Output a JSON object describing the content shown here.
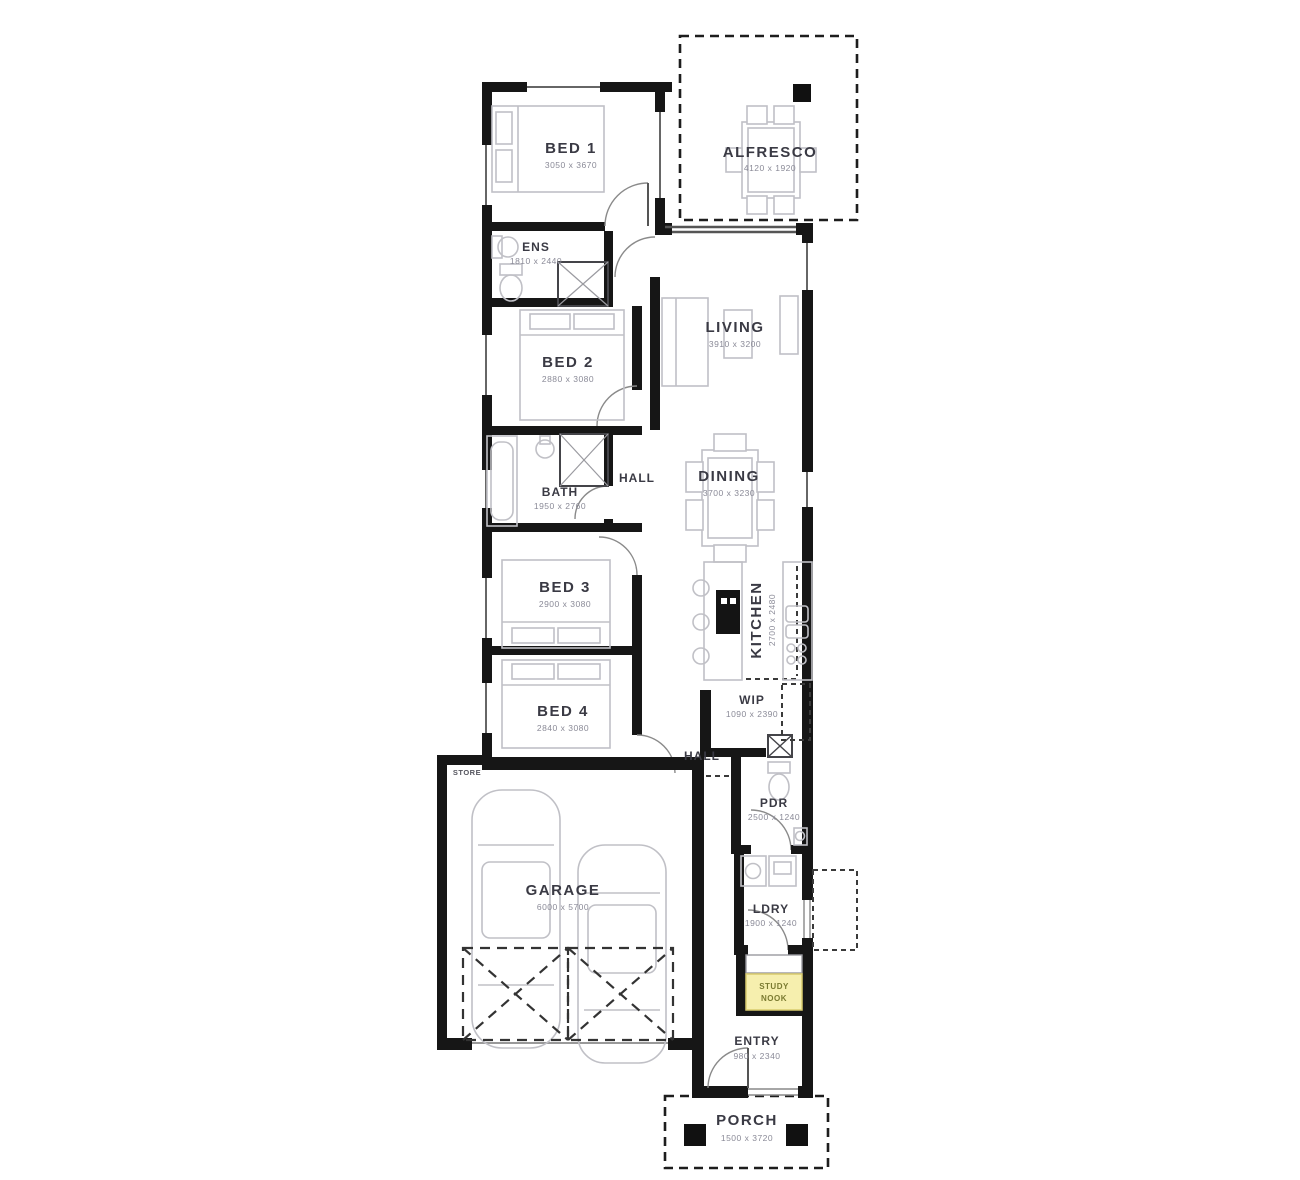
{
  "plan_title": "single storey house floor plan",
  "colors": {
    "wall": "#161616",
    "furniture": "#c0c0c6",
    "label": "#3a3a44",
    "dims": "#8a8a97",
    "nook_fill": "#f6efae",
    "nook_border": "#d9cc6e",
    "background": "#ffffff"
  },
  "rooms": {
    "bed1": {
      "label": "BED 1",
      "dims": "3050 x 3670"
    },
    "alfresco": {
      "label": "ALFRESCO",
      "dims": "4120 x 1920"
    },
    "ens": {
      "label": "ENS",
      "dims": "1810 x 2440"
    },
    "living": {
      "label": "LIVING",
      "dims": "3910 x 3200"
    },
    "bed2": {
      "label": "BED 2",
      "dims": "2880 x 3080"
    },
    "bath": {
      "label": "BATH",
      "dims": "1950 x 2760"
    },
    "dining": {
      "label": "DINING",
      "dims": "3700 x 3230"
    },
    "bed3": {
      "label": "BED 3",
      "dims": "2900 x 3080"
    },
    "kitchen": {
      "label": "KITCHEN",
      "dims": "2700 x 2480"
    },
    "bed4": {
      "label": "BED 4",
      "dims": "2840 x 3080"
    },
    "wip": {
      "label": "WIP",
      "dims": "1090 x 2390"
    },
    "pdr": {
      "label": "PDR",
      "dims": "2500 x 1240"
    },
    "garage": {
      "label": "GARAGE",
      "dims": "6000 x 5700"
    },
    "ldry": {
      "label": "LDRY",
      "dims": "1900 x 1240"
    },
    "entry": {
      "label": "ENTRY",
      "dims": "980 x 2340"
    },
    "porch": {
      "label": "PORCH",
      "dims": "1500 x 3720"
    }
  },
  "labels": {
    "hall_upper": "HALL",
    "hall_lower": "HALL",
    "store": "STORE"
  },
  "study_nook": {
    "line1": "STUDY",
    "line2": "NOOK"
  }
}
